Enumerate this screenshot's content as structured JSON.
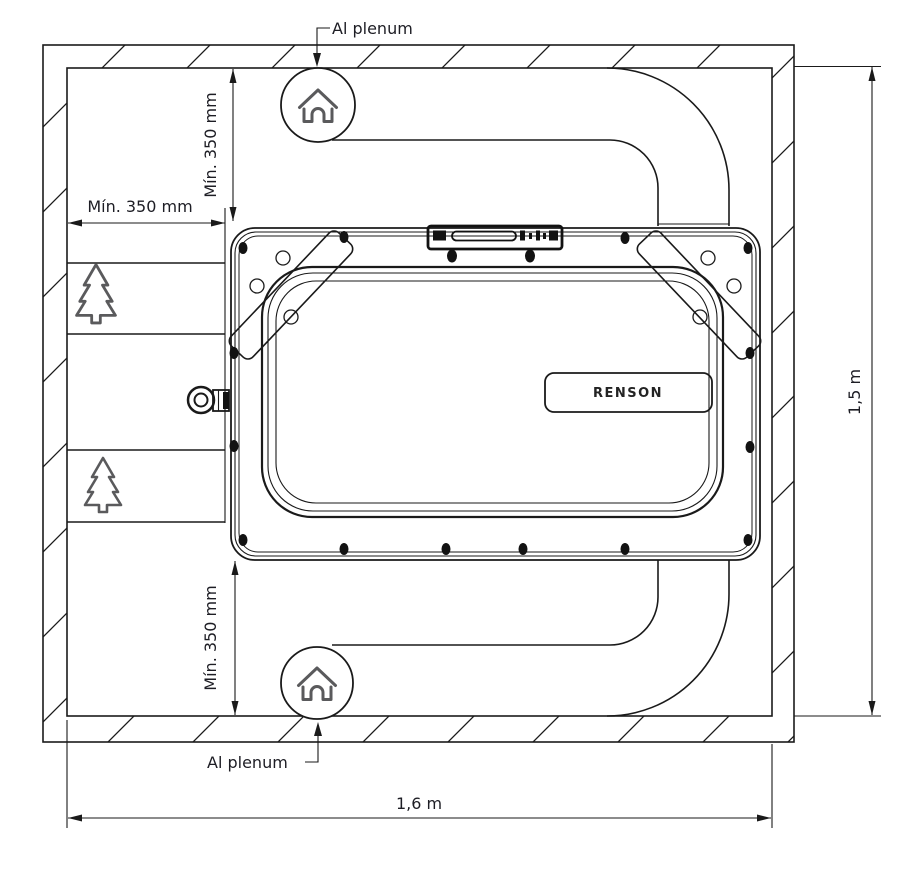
{
  "unit": {
    "logo": "RENSON"
  },
  "dimensions": {
    "overall_width": "1,6 m",
    "overall_height": "1,5 m",
    "clearance_left": "Mín. 350 mm",
    "clearance_top": "Mín. 350 mm",
    "clearance_bottom": "Mín. 350 mm"
  },
  "annotations": {
    "plenum_top": "Al plenum",
    "plenum_bottom": "Al plenum"
  },
  "icons": {
    "house": "house-icon",
    "tree": "tree-icon"
  },
  "colors": {
    "line": "#1a1a1a",
    "text": "#1d1d24",
    "icon_stroke": "#5a5a5c",
    "bolt": "#121212",
    "background": "#ffffff"
  }
}
